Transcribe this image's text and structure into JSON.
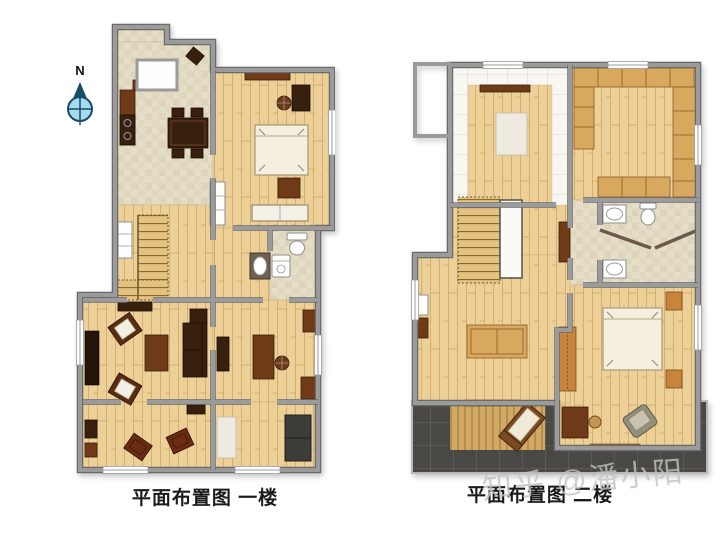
{
  "north": {
    "label": "N"
  },
  "captions": {
    "floor1": "平面布置图 一楼",
    "floor2": "平面布置图 二楼"
  },
  "watermark": {
    "text": "知乎 @潘小阳"
  },
  "colors": {
    "wall": "#9b9b9b",
    "wall_edge": "#6a6a6a",
    "wood": "#ecd098",
    "tile": "#e5ddc7",
    "tile_dark": "#d6cbae",
    "white_floor": "#f8f7f2",
    "bed": "#f4efdf",
    "dark_furn": "#38200f",
    "brown_furn": "#6e3a18",
    "tan_furn": "#d9a85f",
    "orange_furn": "#c8833c",
    "white_furn": "#f3f0e7",
    "gray_furn": "#948e7d",
    "terrace": "#494844",
    "terrace_line": "#5f5e59",
    "deck": "#d2a964",
    "deck_line": "#a07c3c",
    "stair": "#e4c27f",
    "stair_line": "#8a6a33",
    "compass_fill": "#a5dbee",
    "compass_dark": "#1b4a66",
    "caption": "#1b1b1b",
    "watermark": "#c3c3c3"
  }
}
